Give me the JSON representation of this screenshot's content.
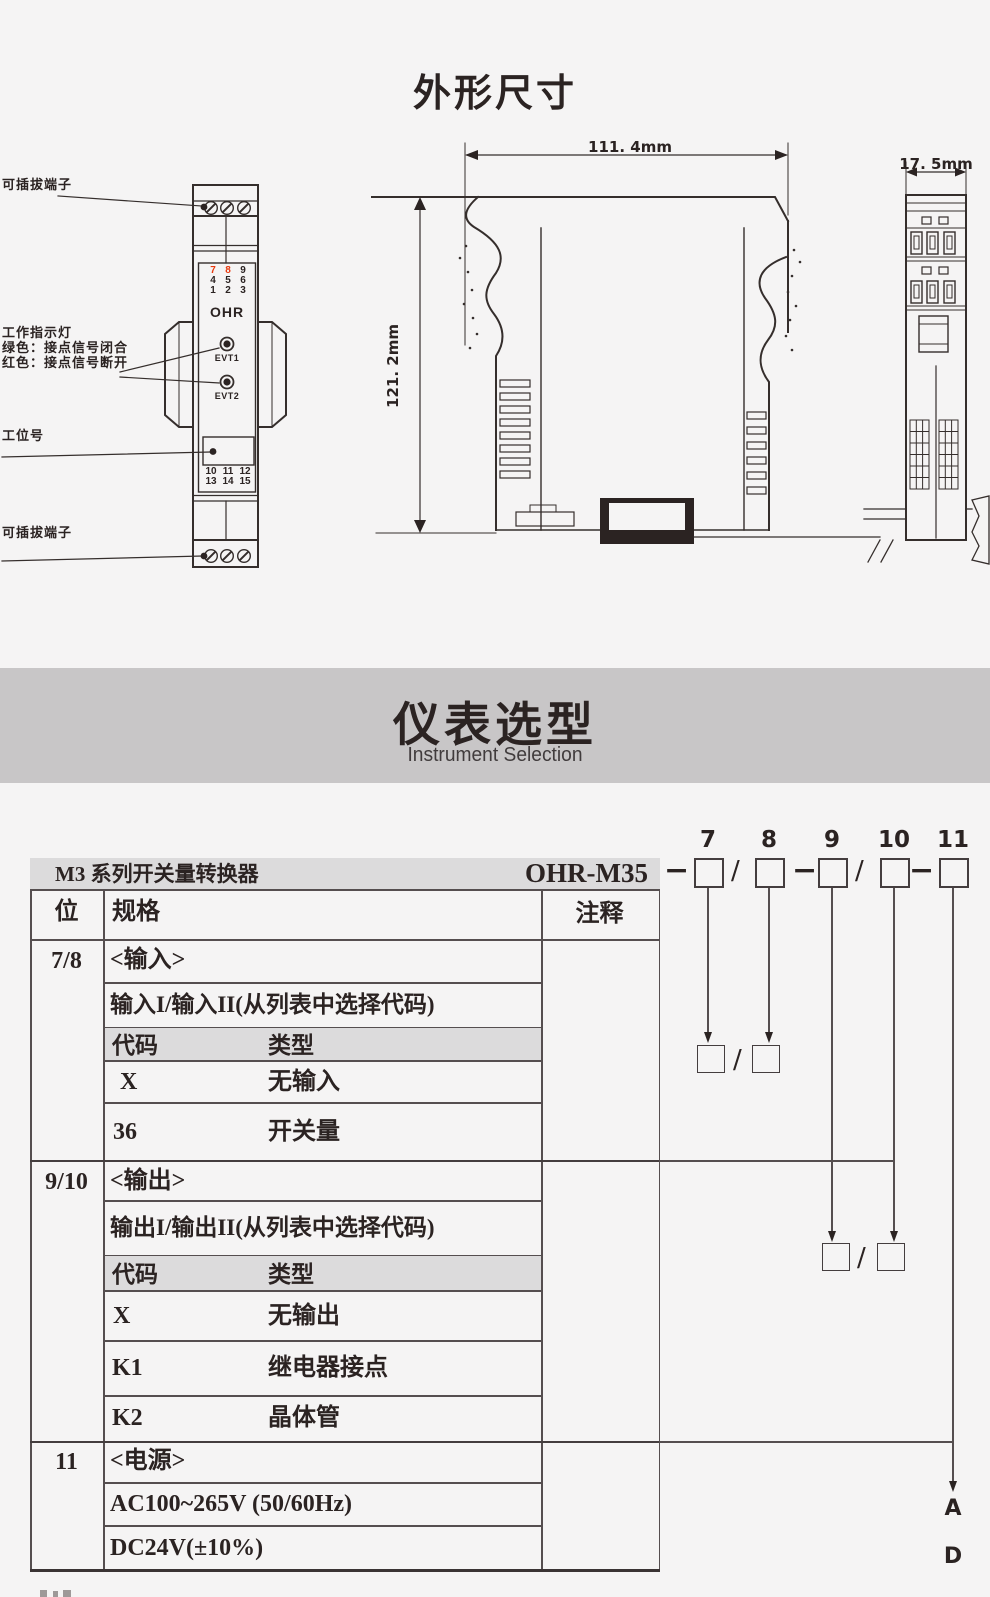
{
  "colors": {
    "accent_red": "#e8380d",
    "banner_bg": "#c8c6c7",
    "band_bg": "#dcdbdc",
    "ink": "#2b2322",
    "line": "#554e4f"
  },
  "outline": {
    "title": "外形尺寸",
    "front_view": {
      "top_terminal_label": "可插拔端子",
      "indicator_label_line1": "工作指示灯",
      "indicator_label_line2": "绿色：接点信号闭合",
      "indicator_label_line3": "红色：接点信号断开",
      "station_label": "工位号",
      "bottom_terminal_label": "可插拔端子",
      "brand": "OHR",
      "led1_label": "EVT1",
      "led2_label": "EVT2",
      "top_digits": [
        [
          "7",
          "8",
          "9"
        ],
        [
          "4",
          "5",
          "6"
        ],
        [
          "1",
          "2",
          "3"
        ]
      ],
      "bottom_digits": [
        [
          "10",
          "11",
          "12"
        ],
        [
          "13",
          "14",
          "15"
        ]
      ]
    },
    "side_view": {
      "width_dim": "111. 4mm",
      "height_dim": "121. 2mm"
    },
    "end_view": {
      "width_dim": "17. 5mm"
    }
  },
  "selection": {
    "banner_title": "仪表选型",
    "banner_subtitle": "Instrument Selection",
    "series_title": "M3 系列开关量转换器",
    "model_code": "OHR-M35",
    "position_labels": [
      "7",
      "8",
      "9",
      "10",
      "11"
    ],
    "dash": "−",
    "slash": "/",
    "table": {
      "col_position": "位",
      "col_spec": "规格",
      "col_note": "注释",
      "sections": [
        {
          "position": "7/8",
          "title": "<输入>",
          "subtitle": "输入I/输入II(从列表中选择代码)",
          "code_header": "代码",
          "type_header": "类型",
          "rows": [
            {
              "code": "X",
              "type": "无输入"
            },
            {
              "code": "36",
              "type": "开关量"
            }
          ]
        },
        {
          "position": "9/10",
          "title": "<输出>",
          "subtitle": "输出I/输出II(从列表中选择代码)",
          "code_header": "代码",
          "type_header": "类型",
          "rows": [
            {
              "code": "X",
              "type": "无输出"
            },
            {
              "code": "K1",
              "type": "继电器接点"
            },
            {
              "code": "K2",
              "type": "晶体管"
            }
          ]
        },
        {
          "position": "11",
          "title": "<电源>",
          "rows": [
            {
              "type": "AC100~265V (50/60Hz)",
              "note": "A"
            },
            {
              "type": "DC24V(±10%)",
              "note": "D"
            }
          ]
        }
      ]
    }
  }
}
